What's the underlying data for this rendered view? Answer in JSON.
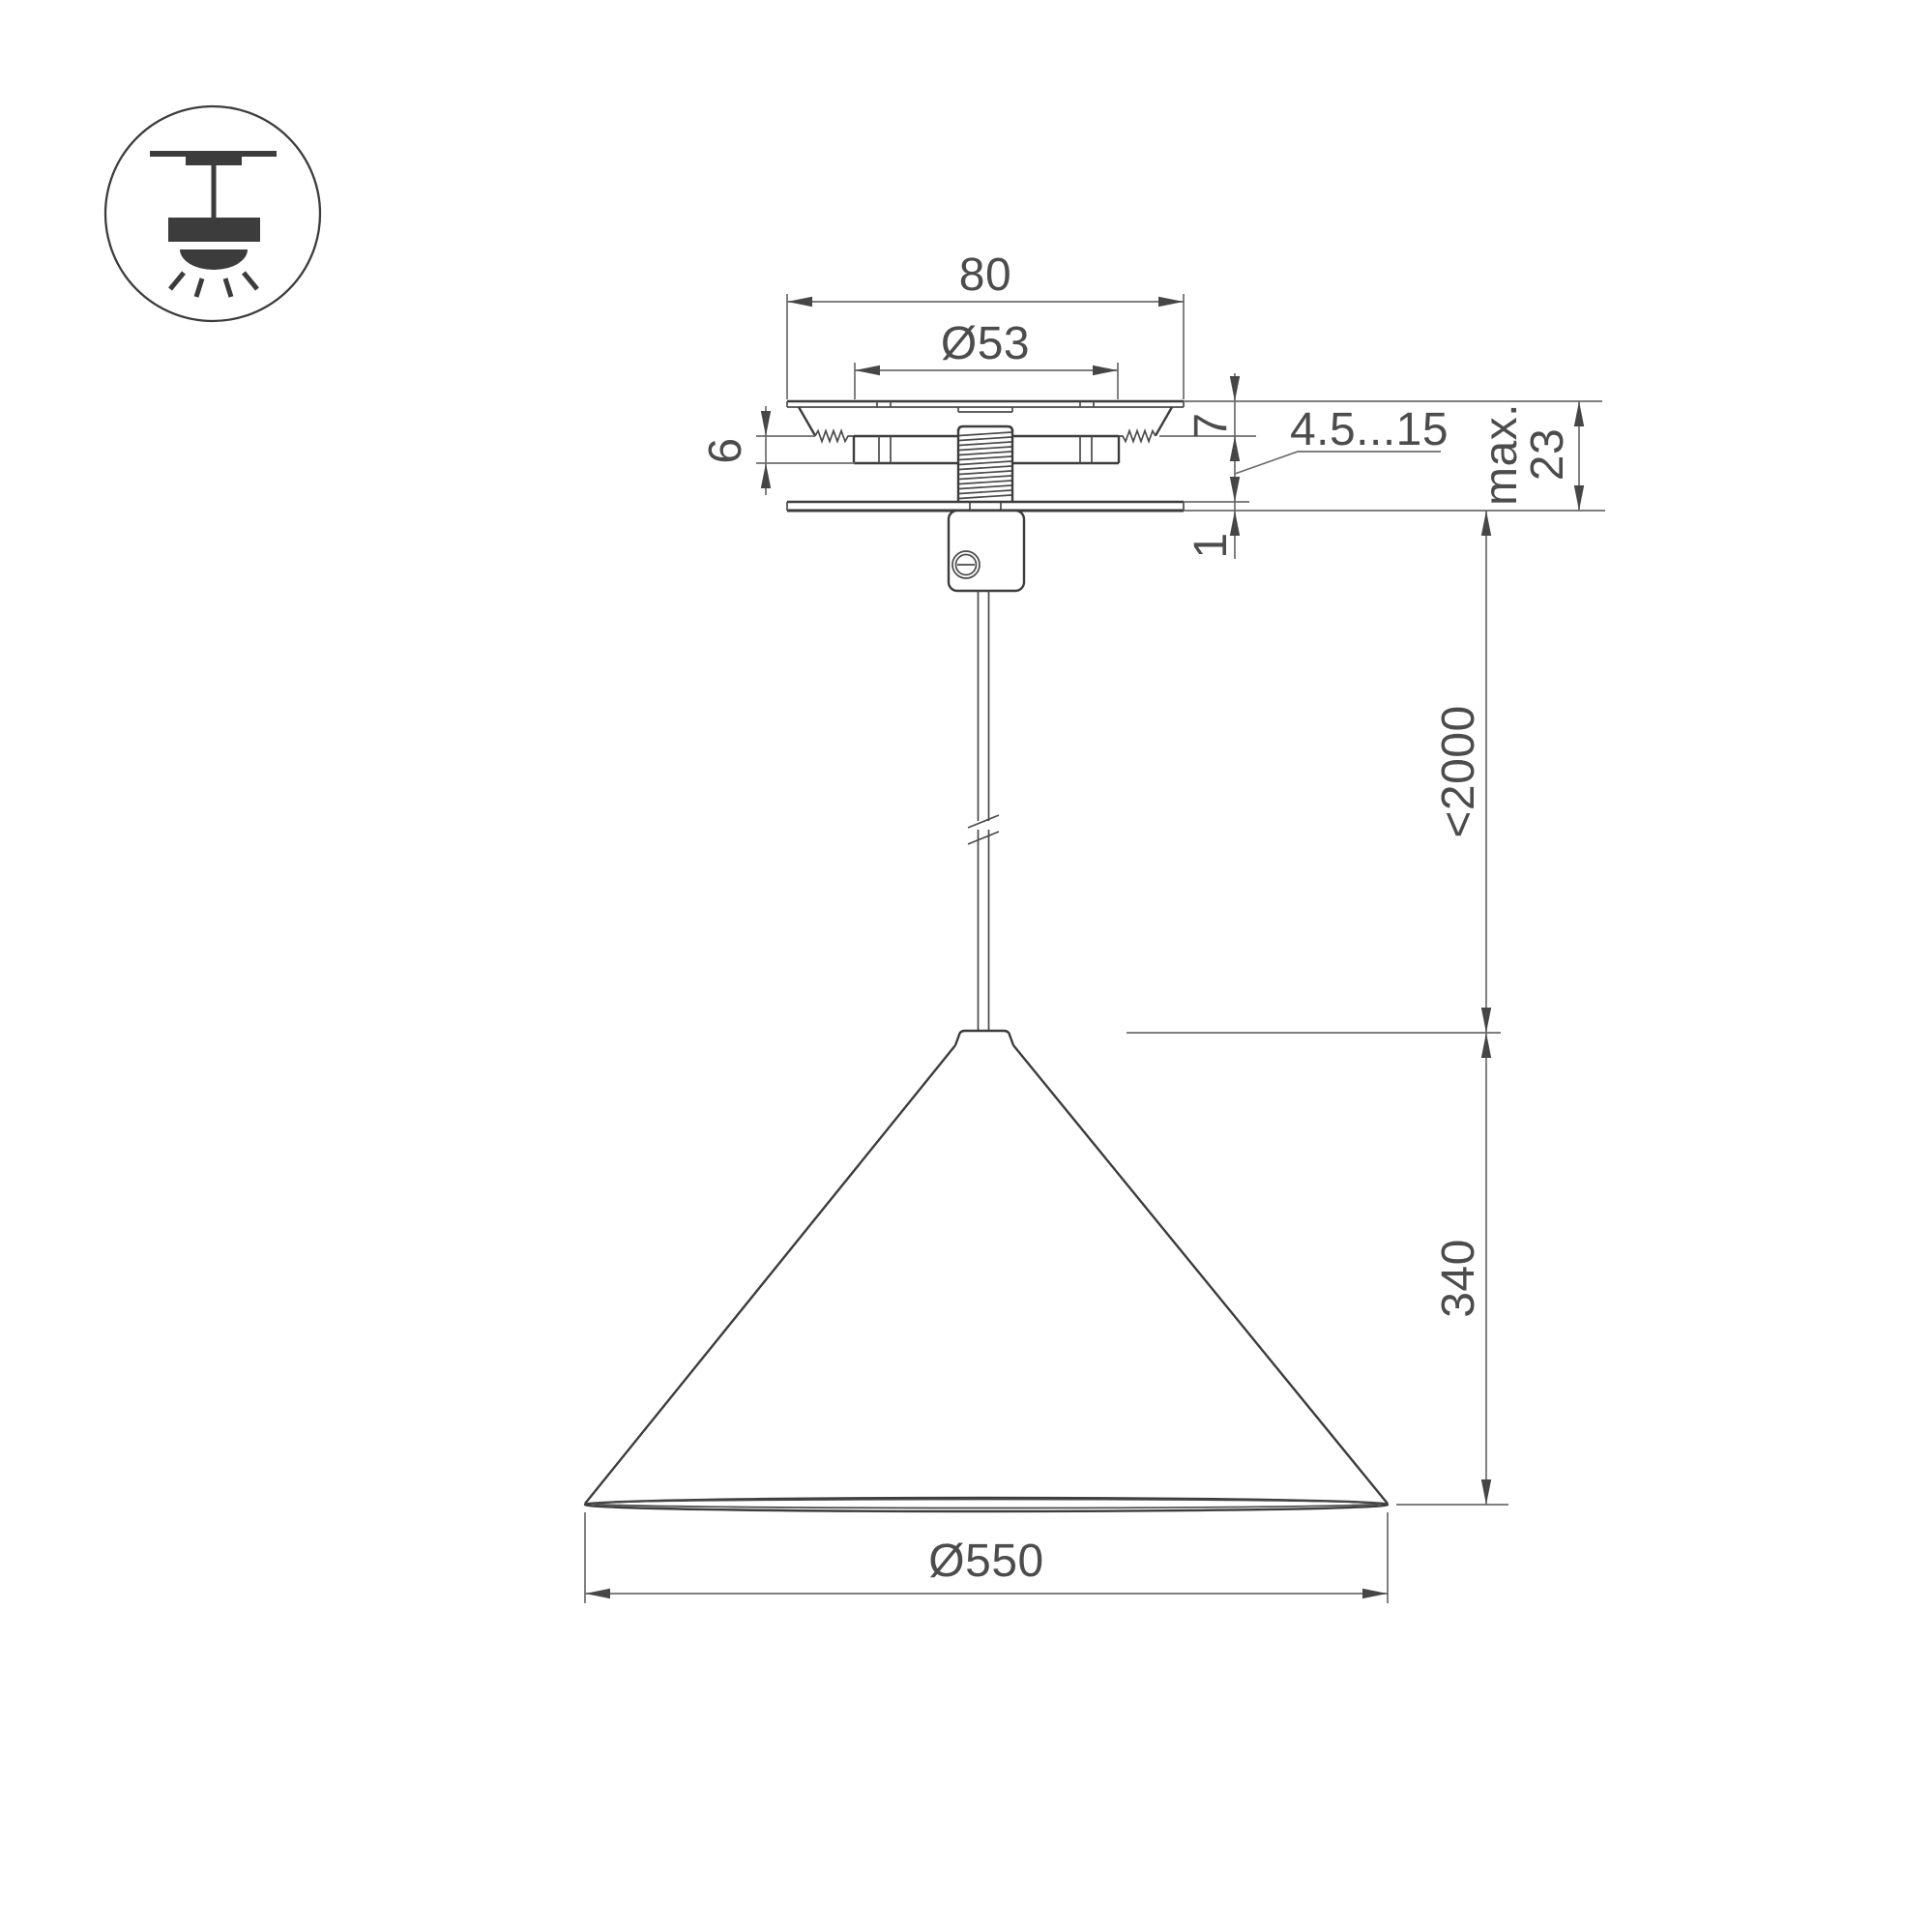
{
  "icon": {
    "name": "ceiling-pendant-lamp-icon"
  },
  "dims": {
    "plate_width": "80",
    "hole_diameter": "Ø53",
    "above_ceiling": "7",
    "bracket_height": "6",
    "ceiling_range": "4.5...15",
    "reveal": "1",
    "cover_diameter": "Ø80",
    "max_label": "max.",
    "max_value": "23",
    "suspension": "<2000",
    "shade_height": "340",
    "shade_diameter": "Ø550"
  },
  "colors": {
    "background": "#ffffff",
    "object_line": "#3c3c3c",
    "dimension_line": "#6b6b6b",
    "arrow": "#464646",
    "text": "#4c4c4c"
  }
}
